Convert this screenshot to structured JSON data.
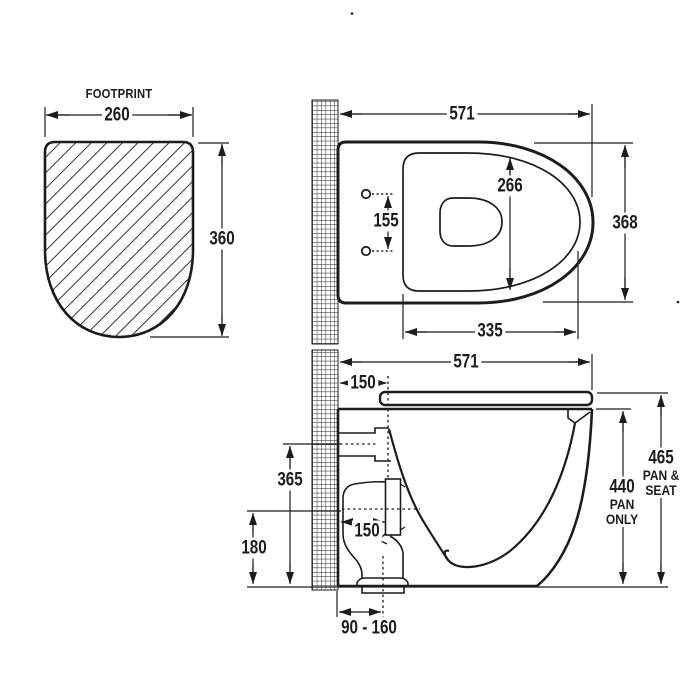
{
  "drawing": {
    "ink_color": "#1c1c1c",
    "footprint": {
      "title": "FOOTPRINT",
      "width": "260",
      "height": "360"
    },
    "top_view": {
      "overall_width": "571",
      "overall_depth": "368",
      "seat_opening_depth": "266",
      "seat_opening_length": "335",
      "fixing_hole_spacing": "155"
    },
    "side_view": {
      "overall_length": "571",
      "hinge_setout": "150",
      "inlet_height": "365",
      "outlet_height": "180",
      "trap_setout": "150",
      "floor_outlet_range": "90 - 160",
      "pan_height": {
        "value": "440",
        "line2": "PAN",
        "line3": "ONLY"
      },
      "pan_seat_height": {
        "value": "465",
        "line2": "PAN &",
        "line3": "SEAT"
      }
    }
  }
}
